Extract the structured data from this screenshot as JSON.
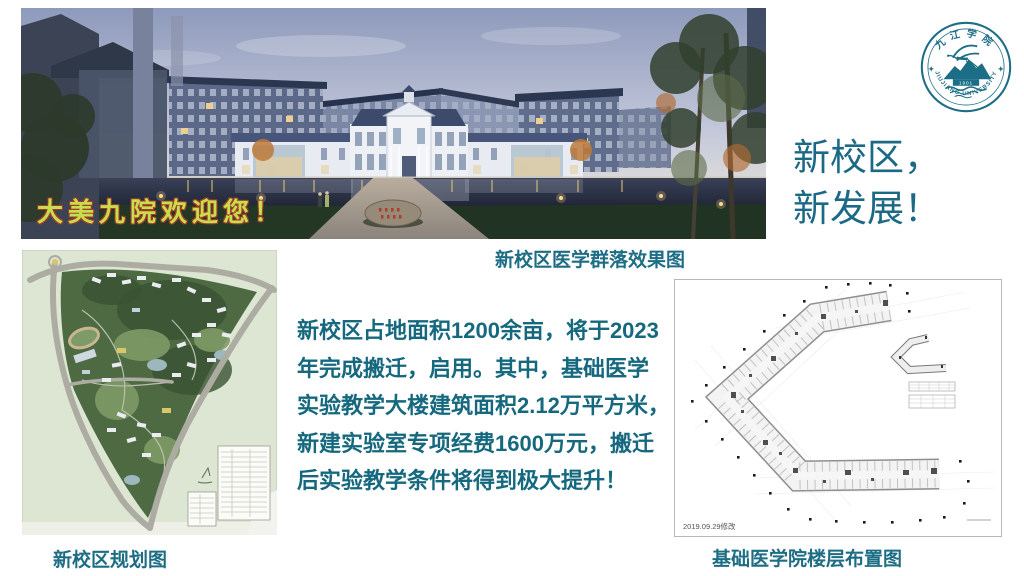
{
  "slide": {
    "background": "#ffffff",
    "accent_teal": "#1c6986"
  },
  "title": {
    "line1": "新校区，",
    "line2": "新发展！"
  },
  "hero": {
    "overlay_text": "大美九院欢迎您！",
    "caption": "新校区医学群落效果图"
  },
  "logo": {
    "name_cn": "九江学院",
    "name_en": "JIUJIANG UNIVERSITY",
    "year": "1901",
    "color": "#1c6d86"
  },
  "master_plan": {
    "caption": "新校区规划图"
  },
  "floor_plan": {
    "caption": "基础医学院楼层布置图",
    "date_note": "2019.09.29修改"
  },
  "paragraph": {
    "lines": [
      "新校区占地面积1200余亩，将于2023",
      "年完成搬迁，启用。其中，基础医学",
      "实验教学大楼建筑面积2.12万平方米，",
      "新建实验室专项经费1600万元，搬迁",
      "后实验教学条件将得到极大提升！"
    ]
  }
}
